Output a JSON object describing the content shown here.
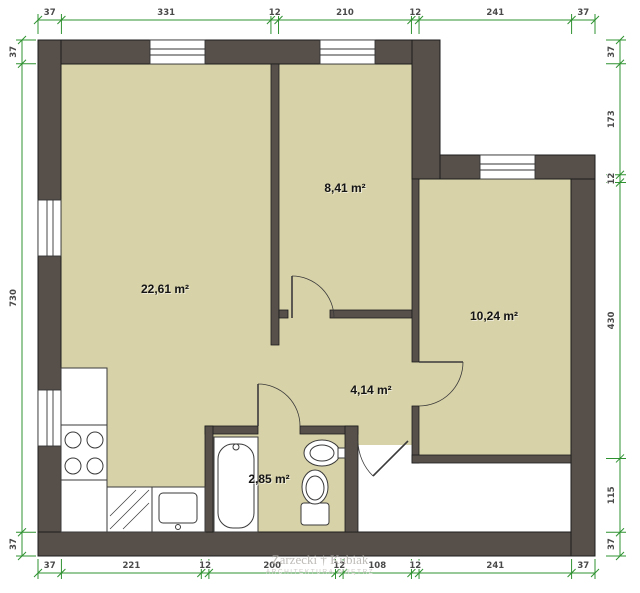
{
  "rooms": [
    {
      "id": "living",
      "area_label": "22,61 m²"
    },
    {
      "id": "room-841",
      "area_label": "8,41 m²"
    },
    {
      "id": "room-1024",
      "area_label": "10,24 m²"
    },
    {
      "id": "hall",
      "area_label": "4,14 m²"
    },
    {
      "id": "bath",
      "area_label": "2,85 m²"
    }
  ],
  "dimensions": {
    "top": [
      "37",
      "331",
      "12",
      "210",
      "12",
      "241",
      "37"
    ],
    "bottom": [
      "37",
      "221",
      "12",
      "200",
      "12",
      "108",
      "12",
      "241",
      "37"
    ],
    "left": [
      "37",
      "730",
      "37"
    ],
    "right": [
      "37",
      "173",
      "12",
      "430",
      "115",
      "37"
    ]
  },
  "watermark": {
    "line1": "Zarzecki † Kubiak",
    "line2": "ARCHITEKTURA WNĘTRZ"
  },
  "colors": {
    "wall": "#57504a",
    "floor": "#d8d2a8",
    "dimension": "#2e9130",
    "fixture_stroke": "#3a3a3a"
  }
}
